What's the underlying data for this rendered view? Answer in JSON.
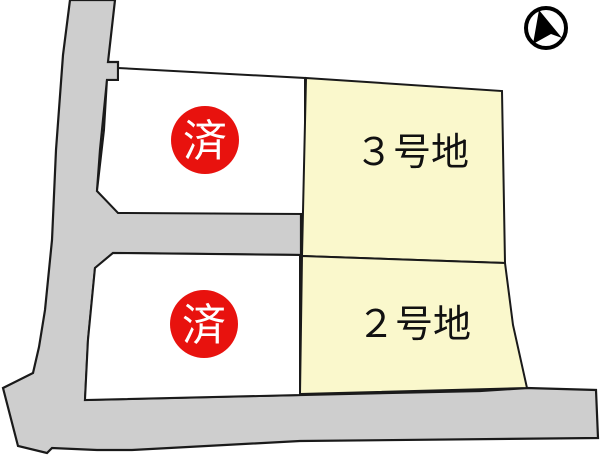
{
  "map": {
    "title": "subdivision-site-plan",
    "lots": {
      "lot3": {
        "label": "３号地"
      },
      "lot2": {
        "label": "２号地"
      },
      "top_left_sold": {
        "badge": "済"
      },
      "bottom_left_sold": {
        "badge": "済"
      }
    }
  },
  "icons": {
    "north_arrow": "north-arrow-icon"
  },
  "colors": {
    "road_fill": "#cecece",
    "lot_sold_fill": "#ffffff",
    "lot_for_sale_fill": "#faf8cc",
    "sold_badge_fill": "#e8120e",
    "sold_badge_text": "#ffffff",
    "outline": "#1a1a1a",
    "compass": "#000000"
  }
}
